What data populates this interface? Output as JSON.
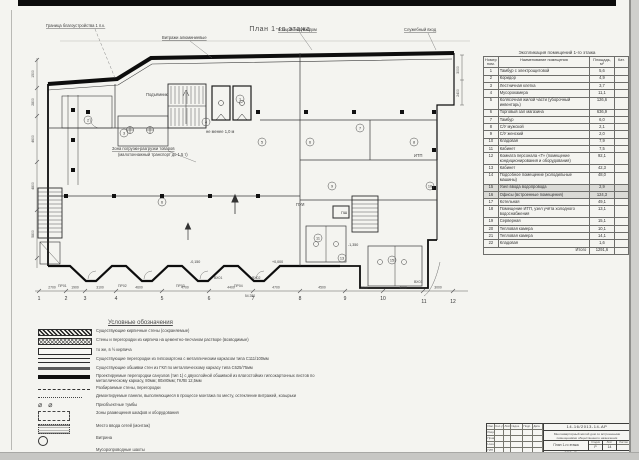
{
  "plan": {
    "title": "План 1-го этажа",
    "axis_numbers": [
      {
        "x": 39,
        "y": 300,
        "t": "1"
      },
      {
        "x": 66,
        "y": 300,
        "t": "2"
      },
      {
        "x": 85,
        "y": 300,
        "t": "3"
      },
      {
        "x": 116,
        "y": 300,
        "t": "4"
      },
      {
        "x": 162,
        "y": 300,
        "t": "5"
      },
      {
        "x": 209,
        "y": 300,
        "t": "6"
      },
      {
        "x": 253,
        "y": 300,
        "t": "7"
      },
      {
        "x": 300,
        "y": 300,
        "t": "8"
      },
      {
        "x": 345,
        "y": 300,
        "t": "9"
      },
      {
        "x": 383,
        "y": 300,
        "t": "10"
      },
      {
        "x": 424,
        "y": 303,
        "t": "11"
      },
      {
        "x": 453,
        "y": 303,
        "t": "12"
      }
    ],
    "ticks_x": [
      39,
      66,
      85,
      116,
      162,
      209,
      253,
      300,
      345,
      383,
      423,
      453
    ],
    "dims_bottom": [
      {
        "x": 52,
        "t": "2700"
      },
      {
        "x": 75,
        "t": "1900"
      },
      {
        "x": 100,
        "t": "3100"
      },
      {
        "x": 139,
        "t": "4600"
      },
      {
        "x": 185,
        "t": "4700"
      },
      {
        "x": 231,
        "t": "4400"
      },
      {
        "x": 276,
        "t": "4700"
      },
      {
        "x": 322,
        "t": "4500"
      },
      {
        "x": 364,
        "t": "3800"
      },
      {
        "x": 403,
        "t": "4000"
      },
      {
        "x": 438,
        "t": "3000"
      }
    ],
    "total_dim": {
      "x": 250,
      "y": 297,
      "t": "54 280"
    },
    "ticks_left_y": [
      60,
      88,
      116,
      162,
      210,
      258
    ],
    "dims_left": [
      {
        "y": 74,
        "t": "1500"
      },
      {
        "y": 102,
        "t": "2800"
      },
      {
        "y": 139,
        "t": "4600"
      },
      {
        "y": 186,
        "t": "4800"
      },
      {
        "y": 234,
        "t": "5800"
      }
    ],
    "dims_right": [
      {
        "y": 70,
        "t": "3000"
      },
      {
        "y": 93,
        "t": "2400"
      }
    ],
    "labels": [
      {
        "x": 46,
        "y": 27,
        "t": "Граница благоустройства 1 п.к.",
        "u": 1
      },
      {
        "x": 162,
        "y": 39,
        "t": "Витражи алюминиевые",
        "u": 1
      },
      {
        "x": 278,
        "y": 31,
        "t": "Козырёк над входом",
        "u": 1
      },
      {
        "x": 404,
        "y": 31,
        "t": "Служебный вход",
        "u": 1
      },
      {
        "x": 112,
        "y": 150,
        "t": "Зона погрузки-разгрузки товаров",
        "u": 1
      },
      {
        "x": 118,
        "y": 156,
        "t": "(малотоннажный транспорт до 1,5 т)",
        "u": 0
      },
      {
        "x": 206,
        "y": 133,
        "t": "не менее 1,0 м",
        "u": 0
      },
      {
        "x": 414,
        "y": 157,
        "t": "ИТП",
        "u": 0
      },
      {
        "x": 296,
        "y": 206,
        "t": "ПУИ",
        "u": 0
      },
      {
        "x": 146,
        "y": 96,
        "t": "Подъёмник",
        "u": 0
      }
    ],
    "box_label": {
      "x": 341,
      "y": 214,
      "t": "ПШ"
    },
    "codes": [
      {
        "x": 58,
        "y": 287,
        "t": "ПР01"
      },
      {
        "x": 118,
        "y": 287,
        "t": "ПР02"
      },
      {
        "x": 176,
        "y": 287,
        "t": "ПР03"
      },
      {
        "x": 234,
        "y": 287,
        "t": "ПР04"
      },
      {
        "x": 214,
        "y": 279,
        "t": "ВХ01"
      },
      {
        "x": 252,
        "y": 279,
        "t": "ВХ02"
      },
      {
        "x": 414,
        "y": 283,
        "t": "ВХ03"
      }
    ],
    "levels": [
      {
        "x": 272,
        "y": 263,
        "t": "+0,000"
      },
      {
        "x": 190,
        "y": 263,
        "t": "-0,150"
      },
      {
        "x": 348,
        "y": 246,
        "t": "-1,350"
      }
    ],
    "rooms": [
      {
        "x": 88,
        "y": 120,
        "n": "2"
      },
      {
        "x": 124,
        "y": 133,
        "n": "3"
      },
      {
        "x": 206,
        "y": 122,
        "n": "4"
      },
      {
        "x": 240,
        "y": 99,
        "n": "1"
      },
      {
        "x": 262,
        "y": 142,
        "n": "5"
      },
      {
        "x": 310,
        "y": 142,
        "n": "6"
      },
      {
        "x": 360,
        "y": 128,
        "n": "7"
      },
      {
        "x": 414,
        "y": 142,
        "n": "8"
      },
      {
        "x": 332,
        "y": 186,
        "n": "9"
      },
      {
        "x": 430,
        "y": 186,
        "n": "10"
      },
      {
        "x": 318,
        "y": 238,
        "n": "11"
      },
      {
        "x": 342,
        "y": 258,
        "n": "13"
      },
      {
        "x": 392,
        "y": 260,
        "n": "15"
      },
      {
        "x": 162,
        "y": 202,
        "n": "6"
      }
    ]
  },
  "table": {
    "title": "Экспликация помещений 1-го этажа",
    "col_num": "Номер пом.",
    "col_name": "Наименование помещения",
    "col_area": "Площадь, м²",
    "col_cat": "Кат.",
    "rows": [
      {
        "num": "1",
        "name": "Тамбур с электрощитовой",
        "area": "5,6",
        "hl": false
      },
      {
        "num": "2",
        "name": "Коридор",
        "area": "4,9",
        "hl": false
      },
      {
        "num": "3",
        "name": "Лестничная клетка",
        "area": "3,7",
        "hl": false
      },
      {
        "num": "4",
        "name": "Мусорокамера",
        "area": "11,1",
        "hl": false
      },
      {
        "num": "5",
        "name": "Колясочная жилой части (уборочный инвентарь)",
        "area": "126,6",
        "hl": false
      },
      {
        "num": "6",
        "name": "Торговый зал магазина",
        "area": "636,9",
        "hl": false
      },
      {
        "num": "7",
        "name": "Тамбур",
        "area": "6,0",
        "hl": false
      },
      {
        "num": "8",
        "name": "С/У мужской",
        "area": "2,1",
        "hl": false
      },
      {
        "num": "9",
        "name": "С/У женский",
        "area": "2,0",
        "hl": false
      },
      {
        "num": "10",
        "name": "Кладовая",
        "area": "7,9",
        "hl": false
      },
      {
        "num": "11",
        "name": "Кабинет",
        "area": "7,5",
        "hl": false
      },
      {
        "num": "12",
        "name": "Комната персонала «Т» (помещение кондиционирования и оборудования)",
        "area": "92,1",
        "hl": false
      },
      {
        "num": "13",
        "name": "Кабинет",
        "area": "42,3",
        "hl": false
      },
      {
        "num": "14",
        "name": "Подсобное помещение (холодильные машины)",
        "area": "48,0",
        "hl": false
      },
      {
        "num": "15",
        "name": "Узел ввода водопровода",
        "area": "2,9",
        "hl": true
      },
      {
        "num": "16",
        "name": "Офисы (встроенные помещения)",
        "area": "124,3",
        "hl": true
      },
      {
        "num": "17",
        "name": "Котельная",
        "area": "49,1",
        "hl": false
      },
      {
        "num": "18",
        "name": "Помещение ИТП, узел учёта холодного водоснабжения",
        "area": "13,1",
        "hl": false
      },
      {
        "num": "19",
        "name": "Серверная",
        "area": "15,1",
        "hl": false
      },
      {
        "num": "20",
        "name": "Тепловая камера",
        "area": "10,1",
        "hl": false
      },
      {
        "num": "21",
        "name": "Тепловая камера",
        "area": "14,1",
        "hl": false
      },
      {
        "num": "22",
        "name": "Кладовая",
        "area": "1,6",
        "hl": false
      }
    ],
    "total_label": "Итого",
    "total_value": "1291,6"
  },
  "legend": {
    "title": "Условные обозначения",
    "items": [
      {
        "symbol": "hatch-diag",
        "bar": true,
        "text": "Существующие кирпичные стены (сохраняемые)"
      },
      {
        "symbol": "hatch-cross",
        "bar": true,
        "text": "Стены и перегородки из кирпича на цементно-песчаном растворе (возводимые)"
      },
      {
        "symbol": "bar-empty",
        "bar": true,
        "text": "то же, в ½ кирпича"
      },
      {
        "symbol": "double",
        "bar": false,
        "text": "Существующие перегородки из гипсокартона с металлическим каркасом типа С111/100мм"
      },
      {
        "symbol": "thick",
        "bar": false,
        "text": "Существующие обшивки стен из ГКЛ по металлическому каркасу типа С625/75мм"
      },
      {
        "symbol": "thick-dark",
        "bar": false,
        "text": "Проектируемые перегородки санузлов (тип 1) с двухслойной обшивкой из влагостойких гипсокартонных листов по металлическому каркасу, 80мм; 80х80мм; ГКЛВ 12,5мм"
      },
      {
        "symbol": "dash",
        "bar": false,
        "text": "Разбираемые стены, перегородки"
      },
      {
        "symbol": "dashdot",
        "bar": false,
        "text": "Демонтируемые панели, выполняющиеся в процессе монтажа по месту, остекление витражей, козырьки"
      },
      {
        "symbol": "circles",
        "bar": false,
        "text": "Приобъектные тумбы"
      },
      {
        "symbol": "dash-rect",
        "bar": false,
        "text": "Зоны размещения шкафов и оборудования"
      },
      {
        "symbol": "dot-rect",
        "bar": false,
        "text": "Место ввода сетей (монтаж)"
      },
      {
        "symbol": "circle",
        "bar": false,
        "text": "Витрина"
      },
      {
        "symbol": "none",
        "bar": false,
        "text": "Мусоропроводные шахты"
      }
    ]
  },
  "stamp": {
    "doc_number": "14-16/2013-14-АР",
    "proj1": "Многоквартирный жилой дом со встроенными",
    "proj2": "помещениями общественного назначения",
    "sheet_name": "План 1-го этажа",
    "stage_label": "Стадия",
    "stage_value": "Р",
    "list_label": "Лист",
    "list_value": "14",
    "lists_label": "Листов",
    "lists_value": "",
    "org": "ООО «Проектная мастерская»",
    "head": [
      "Изм.",
      "Кол.уч",
      "Лист",
      "№док.",
      "Подп.",
      "Дата"
    ],
    "sign_rows": [
      "Разраб.",
      "Провер.",
      "Н.контр.",
      "ГИП"
    ]
  }
}
